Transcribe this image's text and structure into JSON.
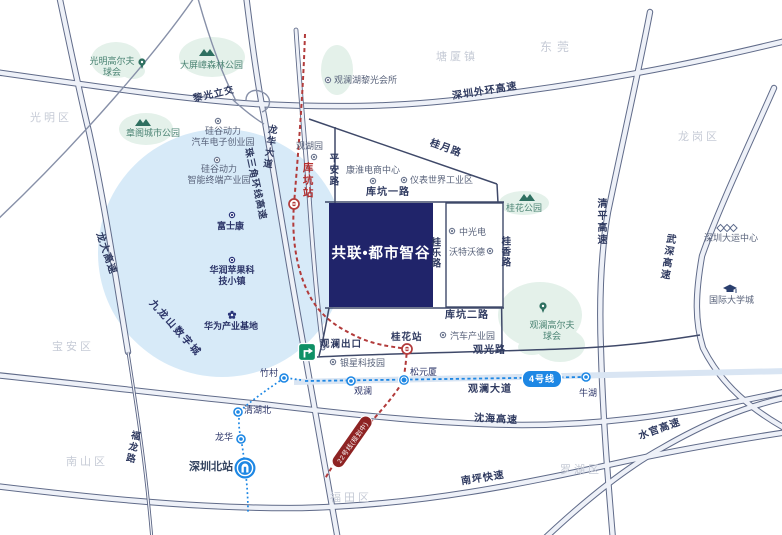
{
  "project": {
    "name": "共联•都市智谷"
  },
  "districts": {
    "guangming": "光明区",
    "baoan": "宝安区",
    "nanshan": "南山区",
    "futian": "福田区",
    "luohu": "罗湖区",
    "longgang": "龙岗区",
    "dongguan": "东莞",
    "tangxia": "塘厦镇"
  },
  "parks": {
    "guangming_golf": "光明高尔夫球会",
    "dapingzhang": "大屏嶂森林公园",
    "zhangge": "章阁城市公园",
    "guihua": "桂花公园",
    "guanlan_golf": "观澜高尔夫球会"
  },
  "pois": {
    "liguang_club": "观澜湖黎光会所",
    "guanhuyuan": "观湖园",
    "kanghuai": "康淮电商中心",
    "yibiao": "仪表世界工业区",
    "guigu_auto": {
      "l1": "硅谷动力",
      "l2": "汽车电子创业园"
    },
    "guigu_smart": {
      "l1": "硅谷动力",
      "l2": "智能终端产业园"
    },
    "zhongguangdian": "中光电",
    "watwd": "沃特沃德",
    "auto_park": "汽车产业园",
    "yinxing": "银星科技园",
    "foxconn": "富士康",
    "huarun": "华润苹果科技小镇",
    "huawei": "华为产业基地",
    "jiulongshan": "九龙山数字城",
    "dayun": "深圳大运中心",
    "univ_city": "国际大学城"
  },
  "roads": {
    "waihuan": "深圳外环高速",
    "liguang_interchange": "黎光立交",
    "zhusanjiao": "珠三角环线高速",
    "longhua_blvd": "龙华大道",
    "longda": "龙大高速",
    "fulong": "福龙路",
    "guiyue": "桂月路",
    "pingan": "平安路",
    "kukeng1": "库坑一路",
    "kukeng2": "库坑二路",
    "guile": "桂乐路",
    "guixiang": "桂香路",
    "qingping": "清平高速",
    "wushen": "武深高速",
    "guanguang": "观光路",
    "guanlan_blvd": "观澜大道",
    "shenhai": "沈海高速",
    "nanping": "南坪快速",
    "shuiguan": "水官高速"
  },
  "metro": {
    "kukeng_station": "库坑站",
    "guihua_station": "桂花站",
    "songyuanxia": "松元厦",
    "guanlan": "观澜",
    "zhucun": "竹村",
    "qinghubei": "清湖北",
    "longhua": "龙华",
    "shenzhen_north": "深圳北站",
    "niuhu": "牛湖",
    "line4_badge": "4号线",
    "line22_badge": "22号线(规划中)",
    "guanlan_exit": "观澜出口"
  },
  "colors": {
    "project_block": "#20246a",
    "metro_blue": "#1d87e4",
    "line22_red": "#b23b3b",
    "park_green": "#e4f1ea",
    "circle_blue": "#d7eaf8",
    "exit_green": "#0f9065"
  }
}
